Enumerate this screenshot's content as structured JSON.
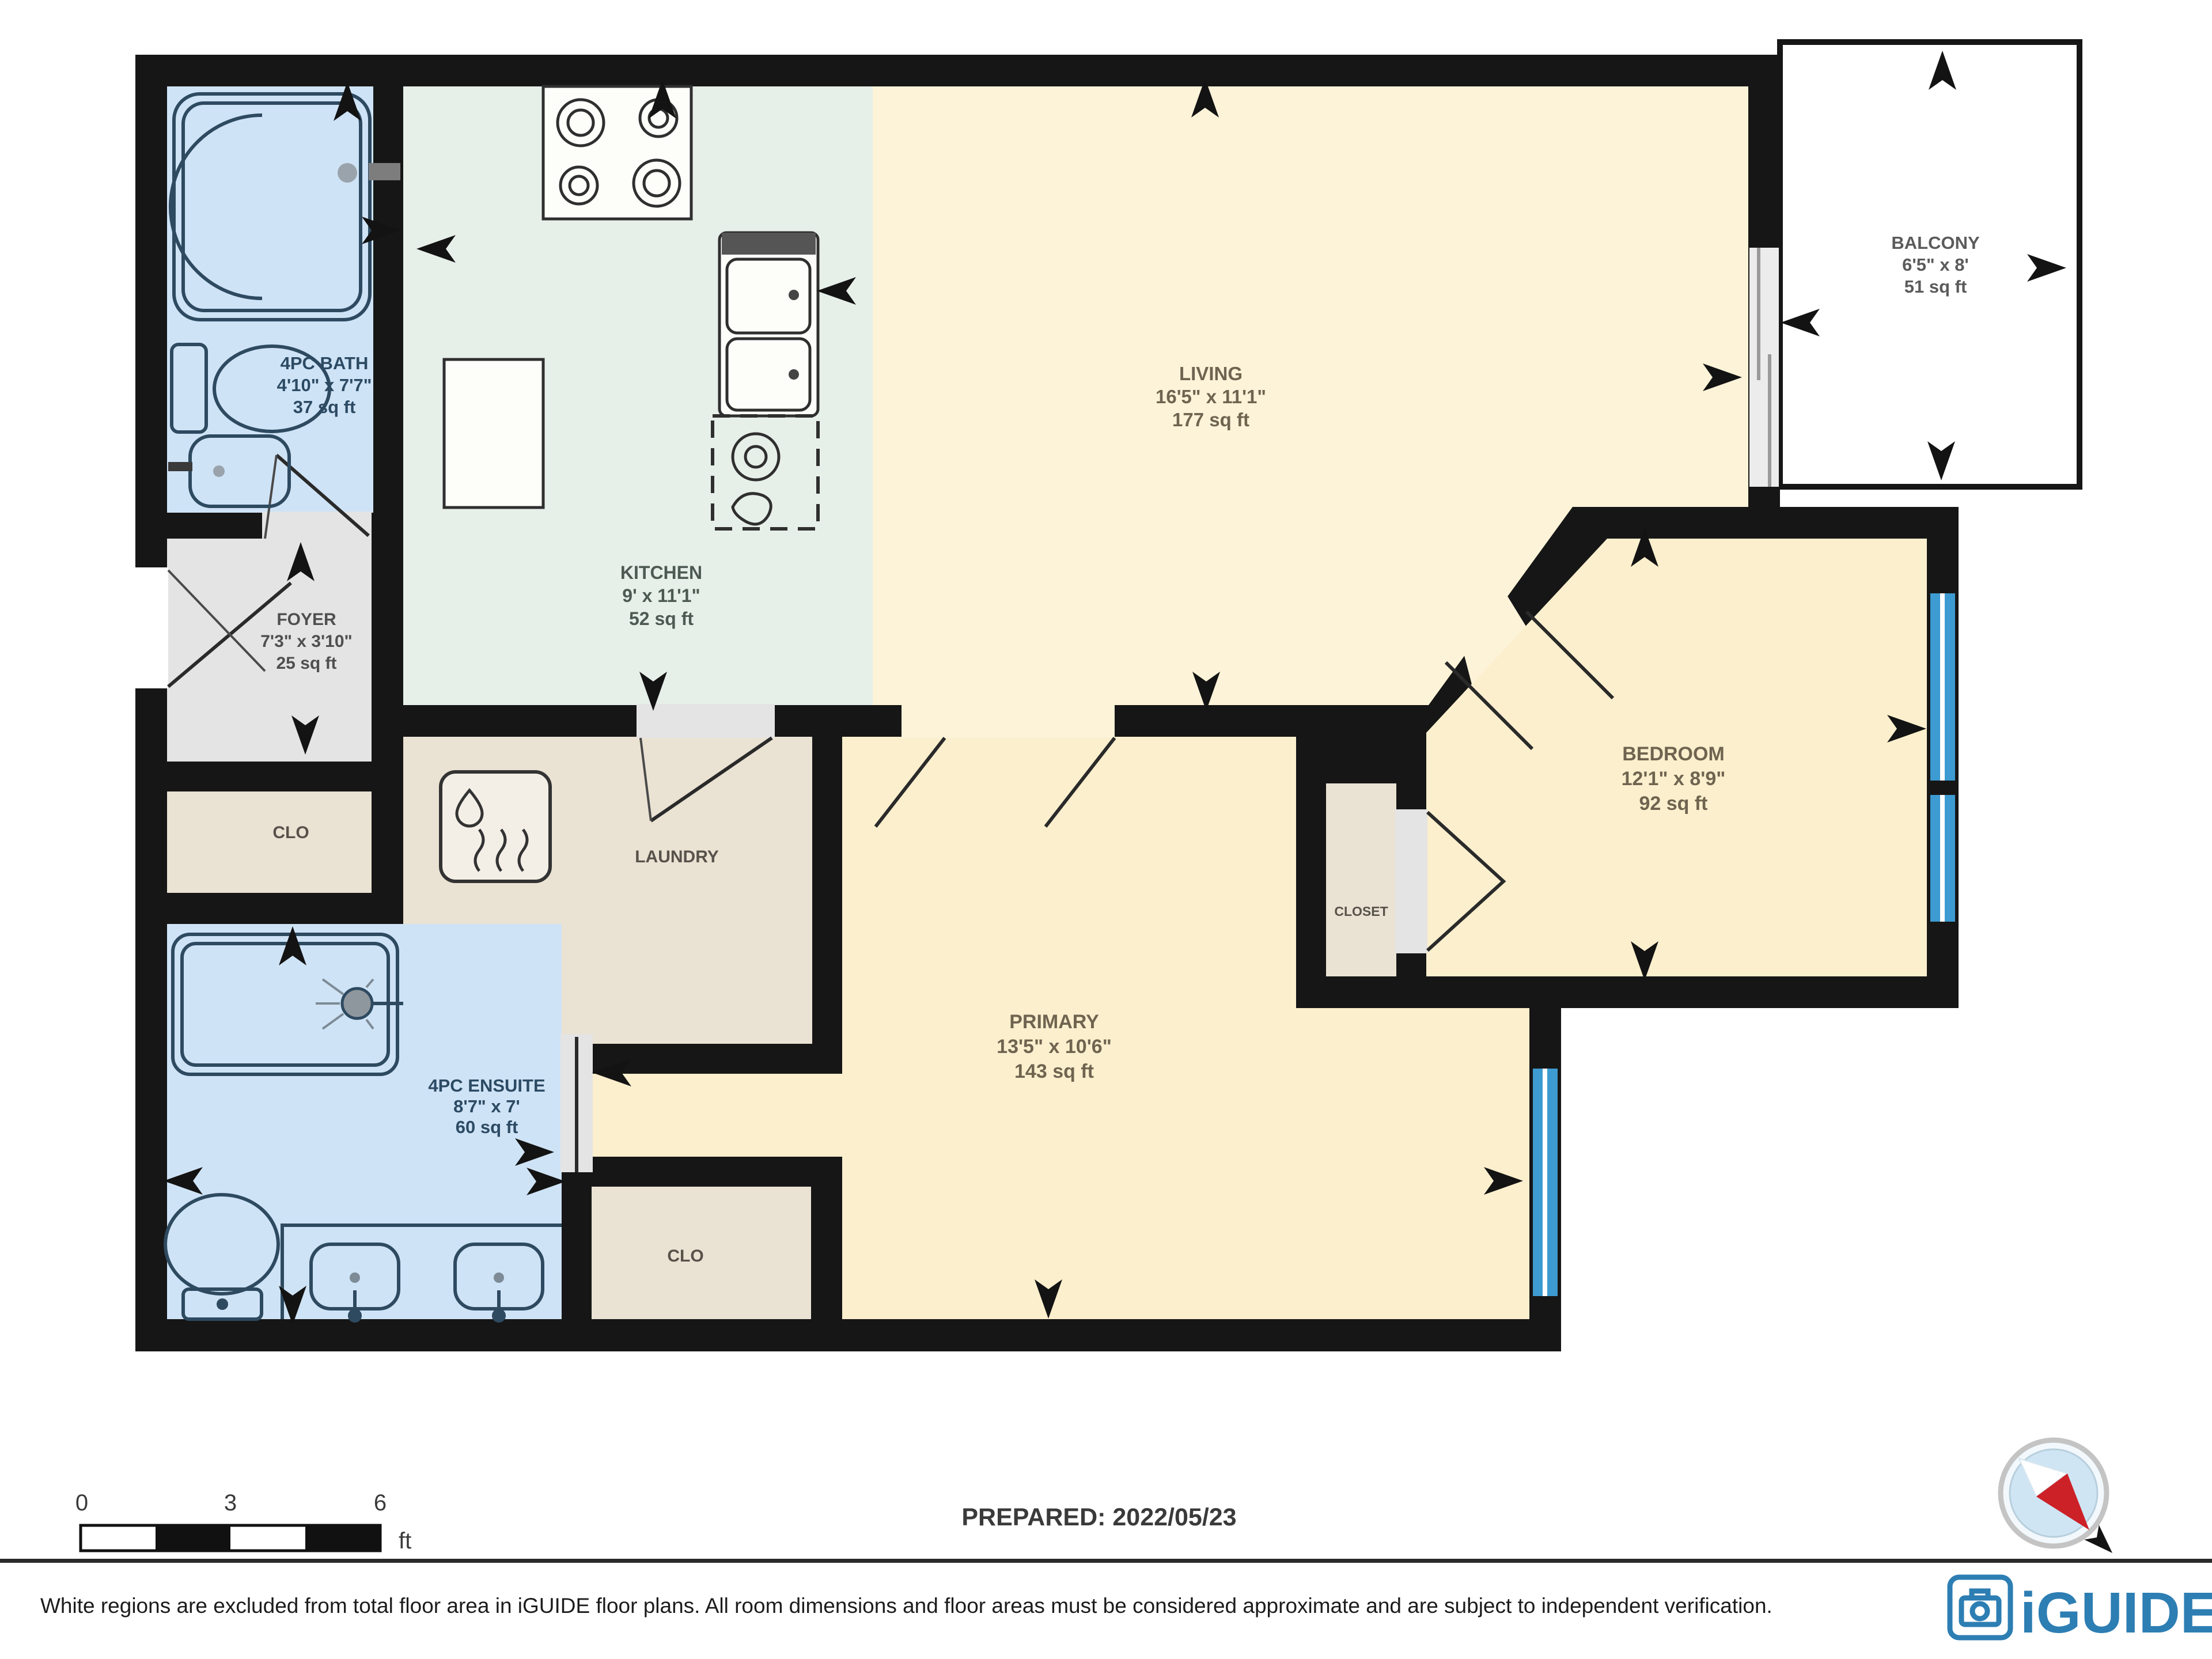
{
  "colors": {
    "wall": "#161616",
    "bath": "#cfe3f6",
    "kitchen": "#e7efe9",
    "living": "#fcf3d8",
    "primary": "#fcefcd",
    "bedroom": "#fcefcd",
    "beige": "#eae2d3",
    "foyer": "#e4e4e4",
    "balcony": "#ffffff",
    "window": "#3d9bd1",
    "door_gap": "#e4e4e4",
    "logo_blue": "#2d7eb3",
    "needle_red": "#cc2127",
    "compass_fill": "#cfe5f4"
  },
  "rooms": {
    "bath": {
      "name": "4PC BATH",
      "dims": "4'10\" x 7'7\"",
      "area": "37 sq ft"
    },
    "kitchen": {
      "name": "KITCHEN",
      "dims": "9' x 11'1\"",
      "area": "52 sq ft"
    },
    "living": {
      "name": "LIVING",
      "dims": "16'5\" x 11'1\"",
      "area": "177 sq ft"
    },
    "balcony": {
      "name": "BALCONY",
      "dims": "6'5\" x 8'",
      "area": "51 sq ft"
    },
    "foyer": {
      "name": "FOYER",
      "dims": "7'3\" x 3'10\"",
      "area": "25 sq ft"
    },
    "closet_top": {
      "name": "CLO"
    },
    "laundry": {
      "name": "LAUNDRY"
    },
    "primary": {
      "name": "PRIMARY",
      "dims": "13'5\" x 10'6\"",
      "area": "143 sq ft"
    },
    "bedroom": {
      "name": "BEDROOM",
      "dims": "12'1\" x 8'9\"",
      "area": "92 sq ft"
    },
    "closet_bedroom": {
      "name": "CLOSET"
    },
    "ensuite": {
      "name": "4PC ENSUITE",
      "dims": "8'7\" x 7'",
      "area": "60 sq ft"
    },
    "closet_bottom": {
      "name": "CLO"
    }
  },
  "scale_bar": {
    "t0": "0",
    "t3": "3",
    "t6": "6",
    "unit": "ft"
  },
  "footer": {
    "prepared": "PREPARED: 2022/05/23",
    "disclaimer": "White regions are excluded from total floor area in iGUIDE floor plans. All room dimensions and floor areas must be considered approximate and are subject to independent verification.",
    "brand": "iGUIDE"
  }
}
